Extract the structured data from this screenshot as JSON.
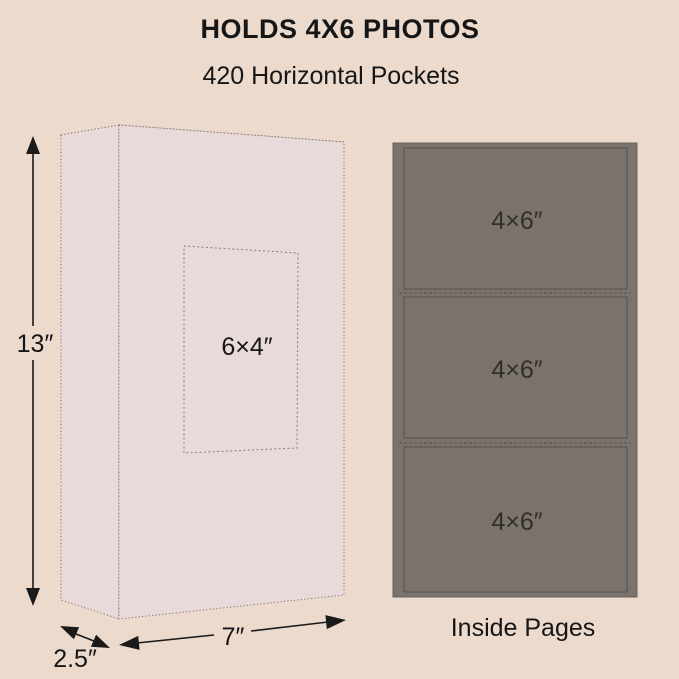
{
  "canvas": {
    "bg": "#ECDACD"
  },
  "header": {
    "title": "HOLDS 4X6 PHOTOS",
    "subtitle": "420 Horizontal Pockets"
  },
  "album": {
    "fill": "#E8D9DB",
    "edge_color": "#80756B",
    "window_edge_color": "#8A7D72",
    "window_label": "6×4″",
    "height_label": "13″",
    "width_label": "7″",
    "depth_label": "2.5″"
  },
  "pages": {
    "fill": "#7A736D",
    "border_color": "#57504B",
    "pocket_labels": [
      "4×6″",
      "4×6″",
      "4×6″"
    ],
    "caption": "Inside Pages"
  }
}
